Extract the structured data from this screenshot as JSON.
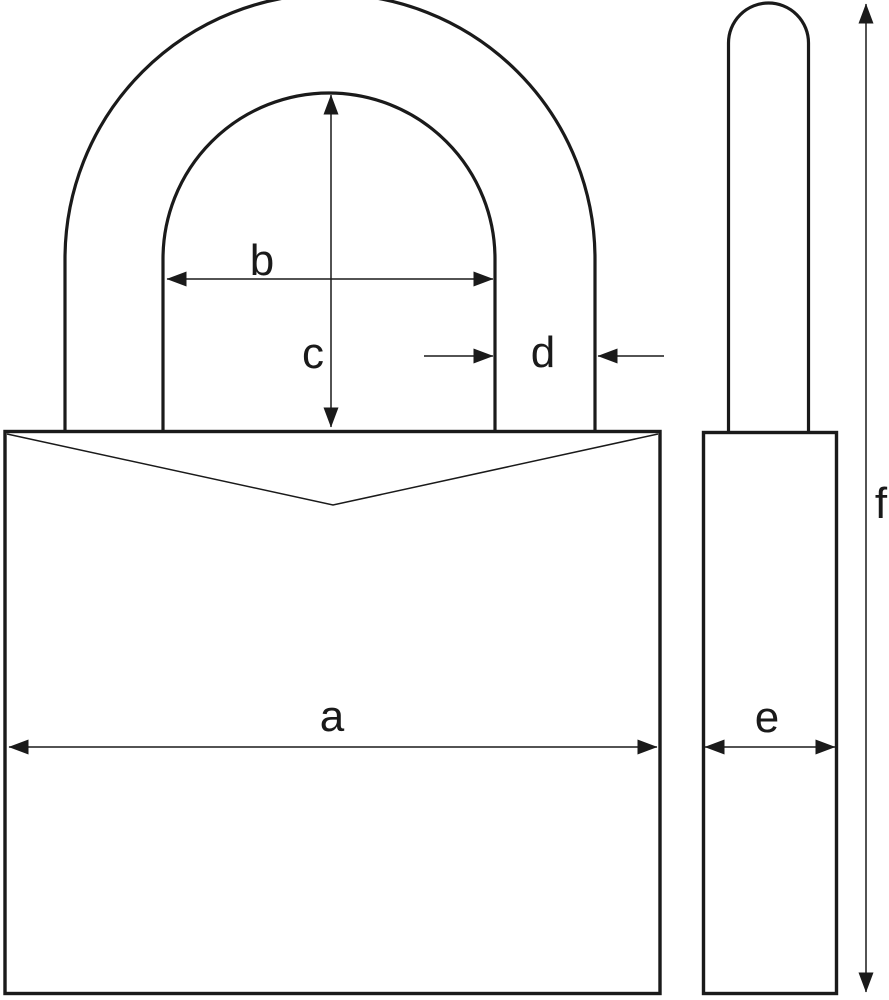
{
  "labels": {
    "a": "a",
    "b": "b",
    "c": "c",
    "d": "d",
    "e": "e",
    "f": "f"
  },
  "colors": {
    "line": "#1a1a1a",
    "background": "#ffffff"
  }
}
